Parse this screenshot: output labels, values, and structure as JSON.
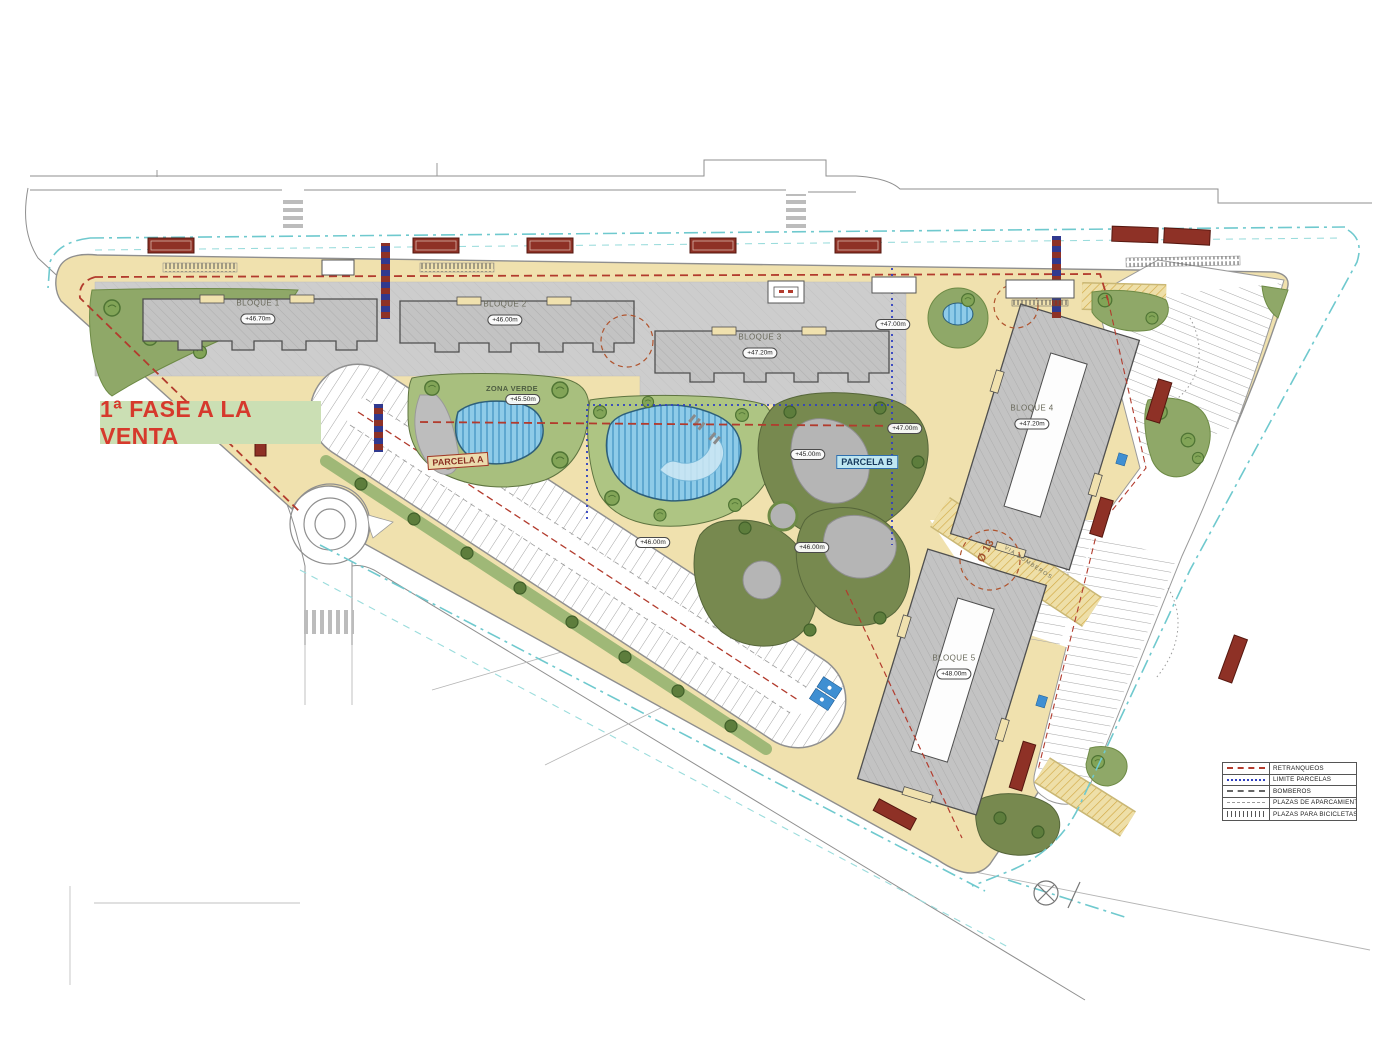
{
  "banner": {
    "label": "1ª FASE A LA VENTA"
  },
  "blocks": [
    {
      "label": "BLOQUE 1",
      "elevation": "+46.70m"
    },
    {
      "label": "BLOQUE 2",
      "elevation": "+46.00m"
    },
    {
      "label": "BLOQUE 3",
      "elevation": "+47.20m"
    },
    {
      "label": "BLOQUE 4",
      "elevation": "+47.20m"
    },
    {
      "label": "BLOQUE 5",
      "elevation": "+48.00m"
    }
  ],
  "areas": {
    "zona_verde": {
      "label": "ZONA VERDE",
      "elevation": "+45.50m"
    },
    "parcela_a": {
      "label": "PARCELA A"
    },
    "parcela_b": {
      "label": "PARCELA B"
    }
  },
  "markers": {
    "m1": "+47.00m",
    "m2": "+47.00m",
    "m3": "+45.00m",
    "m4": "+46.00m",
    "m5": "+46.00m"
  },
  "annotations": {
    "turning_radius": "Ø 13",
    "fire_lane": "VIA BOMBEROS"
  },
  "legend": {
    "items": [
      {
        "label": "RETRANQUEOS",
        "swatch": "red-dashed"
      },
      {
        "label": "LIMITE PARCELAS",
        "swatch": "blue-dotted"
      },
      {
        "label": "BOMBEROS",
        "swatch": "gray-dashed"
      },
      {
        "label": "PLAZAS DE APARCAMIENTO",
        "swatch": "thin-dashed"
      },
      {
        "label": "PLAZAS PARA BICICLETAS",
        "swatch": "tick-hatch"
      }
    ]
  },
  "colors": {
    "site_tan": "#f0e1ae",
    "boundary_cyan": "#6fc9ce",
    "setback_red": "#b23b2d",
    "parcel_blue": "#2f3fc0",
    "green_dark": "#77894f",
    "green_light": "#a8bf7e",
    "water_blue": "#8ecbe8",
    "banner_bg": "#cbdfb4",
    "banner_text": "#d6392c"
  }
}
